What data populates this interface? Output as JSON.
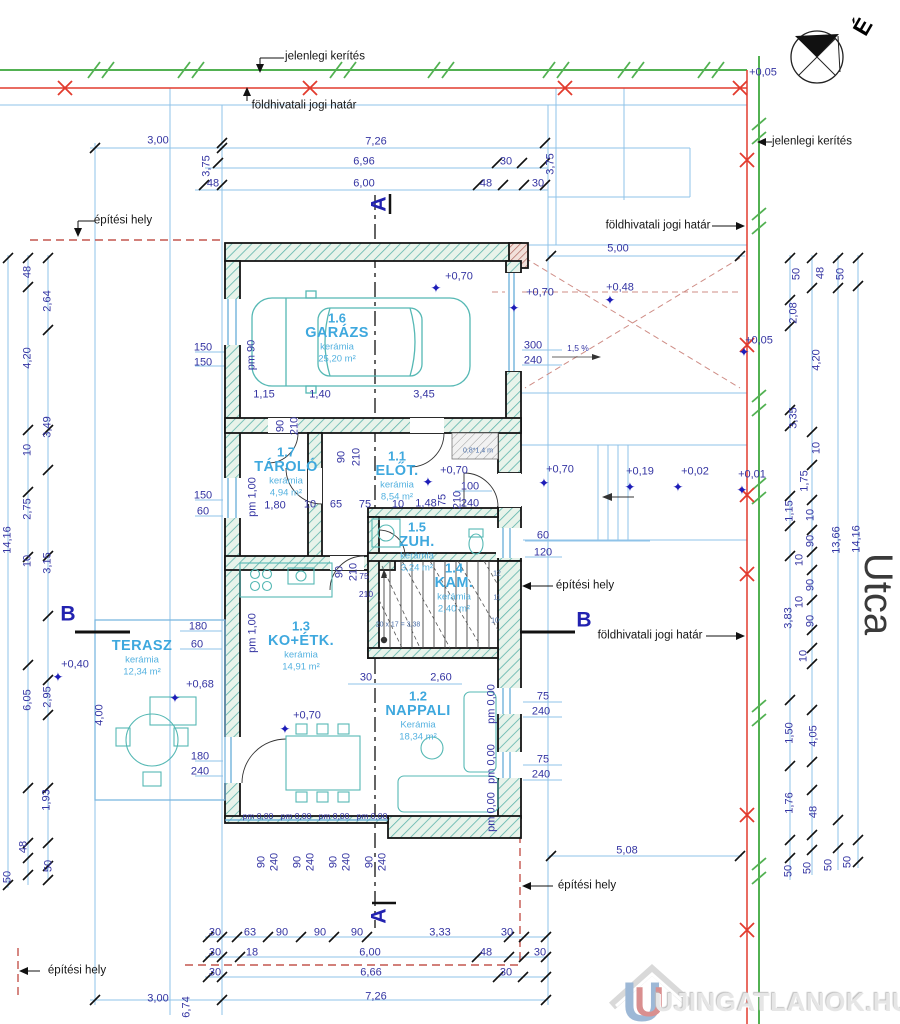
{
  "colors": {
    "dimension_blue": "#3434a2",
    "room_cyan": "#3ea8de",
    "furniture_teal": "#55b8b4",
    "boundary_red": "#e23b2e",
    "fence_green": "#52b152",
    "building_site_dashed": "#c4564e",
    "guide_blue": "#8fc3e8"
  },
  "compass": {
    "north_letter": "É"
  },
  "street": {
    "name": "Utca"
  },
  "watermark": {
    "text": "UJINGATLANOK.HU"
  },
  "rooms": [
    {
      "num": "1.6",
      "name": "GARÁZS",
      "material": "kerámia",
      "area": "25,20 m²",
      "x": 337,
      "y": 318
    },
    {
      "num": "1.7",
      "name": "TÁROLÓ",
      "material": "kerámia",
      "area": "4,94 m²",
      "x": 286,
      "y": 452
    },
    {
      "num": "1.1",
      "name": "ELŐT.",
      "material": "kerámia",
      "area": "8,54 m²",
      "x": 397,
      "y": 456
    },
    {
      "num": "1.5",
      "name": "ZUH.",
      "material": "kerámia",
      "area": "3,24 m²",
      "x": 417,
      "y": 527
    },
    {
      "num": "1.4",
      "name": "KAM.",
      "material": "kerámia",
      "area": "2,40 m²",
      "x": 454,
      "y": 568
    },
    {
      "num": "1.3",
      "name": "KO+ÉTK.",
      "material": "kerámia",
      "area": "14,91 m²",
      "x": 301,
      "y": 626
    },
    {
      "num": "1.2",
      "name": "NAPPALI",
      "material": "Kerámia",
      "area": "18,34 m²",
      "x": 418,
      "y": 696
    },
    {
      "num": "",
      "name": "TERASZ",
      "material": "kerámia",
      "area": "12,34 m²",
      "x": 142,
      "y": 631
    }
  ],
  "labels": [
    {
      "t": "jelenlegi kerítés",
      "x": 325,
      "y": 57,
      "c": "b",
      "n": "label-current-fence-top"
    },
    {
      "t": "földhivatali jogi határ",
      "x": 304,
      "y": 106,
      "c": "b",
      "n": "label-legal-boundary-top"
    },
    {
      "t": "jelenlegi kerítés",
      "x": 812,
      "y": 142,
      "c": "b",
      "n": "label-current-fence-right"
    },
    {
      "t": "földhivatali jogi határ",
      "x": 658,
      "y": 226,
      "c": "b",
      "n": "label-legal-boundary-right"
    },
    {
      "t": "építési hely",
      "x": 123,
      "y": 221,
      "c": "b",
      "n": "label-building-site-topleft"
    },
    {
      "t": "építési hely",
      "x": 585,
      "y": 586,
      "c": "b",
      "n": "label-building-site-right"
    },
    {
      "t": "földhivatali jogi határ",
      "x": 650,
      "y": 636,
      "c": "b",
      "n": "label-legal-boundary-mid"
    },
    {
      "t": "építési hely",
      "x": 587,
      "y": 886,
      "c": "b",
      "n": "label-building-site-bottomright"
    },
    {
      "t": "építési hely",
      "x": 77,
      "y": 971,
      "c": "b",
      "n": "label-building-site-bottomleft"
    },
    {
      "t": "A",
      "x": 379,
      "y": 204,
      "c": "sec",
      "r": -90,
      "n": "section-marker-a-top"
    },
    {
      "t": "A",
      "x": 379,
      "y": 916,
      "c": "sec",
      "r": -90,
      "n": "section-marker-a-bottom"
    },
    {
      "t": "B",
      "x": 68,
      "y": 614,
      "c": "sec",
      "n": "section-marker-b-left"
    },
    {
      "t": "B",
      "x": 584,
      "y": 620,
      "c": "sec",
      "n": "section-marker-b-right"
    },
    {
      "t": "Utca",
      "x": 878,
      "y": 594,
      "c": "u",
      "r": 90,
      "n": "street-name"
    },
    {
      "t": "É",
      "x": 863,
      "y": 27,
      "c": "comp",
      "r": -60,
      "n": "north-letter"
    },
    {
      "t": "UJINGATLANOK.HU",
      "x": 783,
      "y": 1002,
      "c": "wm",
      "n": "watermark-text"
    },
    {
      "t": "+0,05",
      "x": 763,
      "y": 73,
      "c": "d"
    },
    {
      "t": "3,00",
      "x": 158,
      "y": 141,
      "c": "d"
    },
    {
      "t": "7,26",
      "x": 376,
      "y": 142,
      "c": "d"
    },
    {
      "t": "6,96",
      "x": 364,
      "y": 162,
      "c": "d"
    },
    {
      "t": "30",
      "x": 506,
      "y": 162,
      "c": "d"
    },
    {
      "t": "3,75",
      "x": 207,
      "y": 166,
      "c": "d",
      "r": -90
    },
    {
      "t": "3,75",
      "x": 551,
      "y": 164,
      "c": "d",
      "r": -90
    },
    {
      "t": "48",
      "x": 213,
      "y": 184,
      "c": "d"
    },
    {
      "t": "6,00",
      "x": 364,
      "y": 184,
      "c": "d"
    },
    {
      "t": "48",
      "x": 486,
      "y": 184,
      "c": "d"
    },
    {
      "t": "30",
      "x": 538,
      "y": 184,
      "c": "d"
    },
    {
      "t": "5,00",
      "x": 618,
      "y": 249,
      "c": "d"
    },
    {
      "t": "+0,48",
      "x": 620,
      "y": 288,
      "c": "d"
    },
    {
      "t": "✦",
      "x": 610,
      "y": 300,
      "c": "s"
    },
    {
      "t": "+0,70",
      "x": 459,
      "y": 277,
      "c": "d"
    },
    {
      "t": "✦",
      "x": 436,
      "y": 288,
      "c": "s"
    },
    {
      "t": "+0,70",
      "x": 540,
      "y": 293,
      "c": "d"
    },
    {
      "t": "✦",
      "x": 514,
      "y": 308,
      "c": "s"
    },
    {
      "t": "+0,05",
      "x": 759,
      "y": 341,
      "c": "d"
    },
    {
      "t": "✦",
      "x": 744,
      "y": 352,
      "c": "s"
    },
    {
      "t": "150",
      "x": 203,
      "y": 348,
      "c": "d"
    },
    {
      "t": "150",
      "x": 203,
      "y": 363,
      "c": "d"
    },
    {
      "t": "pm 90",
      "x": 252,
      "y": 355,
      "c": "d",
      "r": -90
    },
    {
      "t": "300",
      "x": 533,
      "y": 346,
      "c": "d"
    },
    {
      "t": "240",
      "x": 533,
      "y": 361,
      "c": "d"
    },
    {
      "t": "1,5 %",
      "x": 578,
      "y": 348,
      "c": "d10"
    },
    {
      "t": "1,15",
      "x": 264,
      "y": 395,
      "c": "d"
    },
    {
      "t": "1,40",
      "x": 320,
      "y": 395,
      "c": "d"
    },
    {
      "t": "3,45",
      "x": 424,
      "y": 395,
      "c": "d"
    },
    {
      "t": "90",
      "x": 281,
      "y": 426,
      "c": "d",
      "r": -90
    },
    {
      "t": "210",
      "x": 295,
      "y": 426,
      "c": "d",
      "r": -90
    },
    {
      "t": "90",
      "x": 342,
      "y": 457,
      "c": "d",
      "r": -90
    },
    {
      "t": "210",
      "x": 357,
      "y": 457,
      "c": "d",
      "r": -90
    },
    {
      "t": "0,8*1,4 m",
      "x": 478,
      "y": 451,
      "c": "t"
    },
    {
      "t": "+0,70",
      "x": 454,
      "y": 471,
      "c": "d"
    },
    {
      "t": "✦",
      "x": 428,
      "y": 482,
      "c": "s"
    },
    {
      "t": "100",
      "x": 470,
      "y": 487,
      "c": "d"
    },
    {
      "t": "240",
      "x": 470,
      "y": 504,
      "c": "d"
    },
    {
      "t": "75",
      "x": 443,
      "y": 500,
      "c": "d",
      "r": -90
    },
    {
      "t": "210",
      "x": 458,
      "y": 500,
      "c": "d",
      "r": -90
    },
    {
      "t": "150",
      "x": 203,
      "y": 496,
      "c": "d"
    },
    {
      "t": "60",
      "x": 203,
      "y": 512,
      "c": "d"
    },
    {
      "t": "pm 1,00",
      "x": 253,
      "y": 497,
      "c": "d",
      "r": -90
    },
    {
      "t": "1,80",
      "x": 275,
      "y": 506,
      "c": "d"
    },
    {
      "t": "10",
      "x": 310,
      "y": 505,
      "c": "d"
    },
    {
      "t": "65",
      "x": 336,
      "y": 505,
      "c": "d"
    },
    {
      "t": "75",
      "x": 365,
      "y": 505,
      "c": "d"
    },
    {
      "t": "10",
      "x": 398,
      "y": 505,
      "c": "d"
    },
    {
      "t": "1,48",
      "x": 426,
      "y": 504,
      "c": "d"
    },
    {
      "t": "+0,70",
      "x": 560,
      "y": 470,
      "c": "d"
    },
    {
      "t": "✦",
      "x": 544,
      "y": 483,
      "c": "s"
    },
    {
      "t": "+0,19",
      "x": 640,
      "y": 472,
      "c": "d"
    },
    {
      "t": "✦",
      "x": 630,
      "y": 487,
      "c": "s"
    },
    {
      "t": "+0,02",
      "x": 695,
      "y": 472,
      "c": "d"
    },
    {
      "t": "✦",
      "x": 678,
      "y": 487,
      "c": "s"
    },
    {
      "t": "+0,01",
      "x": 752,
      "y": 475,
      "c": "d"
    },
    {
      "t": "✦",
      "x": 742,
      "y": 490,
      "c": "s"
    },
    {
      "t": "60",
      "x": 543,
      "y": 536,
      "c": "d"
    },
    {
      "t": "120",
      "x": 543,
      "y": 553,
      "c": "d"
    },
    {
      "t": "75",
      "x": 364,
      "y": 576,
      "c": "d10"
    },
    {
      "t": "210",
      "x": 366,
      "y": 594,
      "c": "d10"
    },
    {
      "t": "90",
      "x": 340,
      "y": 572,
      "c": "d",
      "r": -90
    },
    {
      "t": "210",
      "x": 354,
      "y": 572,
      "c": "d",
      "r": -90
    },
    {
      "t": "12",
      "x": 497,
      "y": 574,
      "c": "t"
    },
    {
      "t": "11",
      "x": 497,
      "y": 598,
      "c": "t"
    },
    {
      "t": "10",
      "x": 495,
      "y": 621,
      "c": "t"
    },
    {
      "t": "20 x 17 = 3,38",
      "x": 398,
      "y": 625,
      "c": "t"
    },
    {
      "t": "180",
      "x": 198,
      "y": 627,
      "c": "d"
    },
    {
      "t": "60",
      "x": 197,
      "y": 645,
      "c": "d"
    },
    {
      "t": "pm 1,00",
      "x": 253,
      "y": 633,
      "c": "d",
      "r": -90
    },
    {
      "t": "+0,70",
      "x": 307,
      "y": 716,
      "c": "d"
    },
    {
      "t": "✦",
      "x": 285,
      "y": 729,
      "c": "s"
    },
    {
      "t": "+0,68",
      "x": 200,
      "y": 685,
      "c": "d"
    },
    {
      "t": "✦",
      "x": 175,
      "y": 698,
      "c": "s"
    },
    {
      "t": "+0,40",
      "x": 75,
      "y": 665,
      "c": "d"
    },
    {
      "t": "✦",
      "x": 58,
      "y": 677,
      "c": "s"
    },
    {
      "t": "4,00",
      "x": 100,
      "y": 715,
      "c": "d",
      "r": -90
    },
    {
      "t": "30",
      "x": 366,
      "y": 678,
      "c": "d"
    },
    {
      "t": "2,60",
      "x": 441,
      "y": 678,
      "c": "d"
    },
    {
      "t": "pm 0,00",
      "x": 492,
      "y": 704,
      "c": "d",
      "r": -90
    },
    {
      "t": "pm 0,00",
      "x": 492,
      "y": 764,
      "c": "d",
      "r": -90
    },
    {
      "t": "pm 0,00",
      "x": 492,
      "y": 812,
      "c": "d",
      "r": -90
    },
    {
      "t": "75",
      "x": 543,
      "y": 697,
      "c": "d"
    },
    {
      "t": "240",
      "x": 541,
      "y": 712,
      "c": "d"
    },
    {
      "t": "75",
      "x": 543,
      "y": 760,
      "c": "d"
    },
    {
      "t": "240",
      "x": 541,
      "y": 775,
      "c": "d"
    },
    {
      "t": "180",
      "x": 200,
      "y": 757,
      "c": "d"
    },
    {
      "t": "240",
      "x": 200,
      "y": 772,
      "c": "d"
    },
    {
      "t": "pm 0,00",
      "x": 258,
      "y": 816,
      "c": "d10"
    },
    {
      "t": "pm 0,00",
      "x": 296,
      "y": 816,
      "c": "d10"
    },
    {
      "t": "pm 0,00",
      "x": 334,
      "y": 816,
      "c": "d10"
    },
    {
      "t": "pm 0,00",
      "x": 372,
      "y": 816,
      "c": "d10"
    },
    {
      "t": "90",
      "x": 262,
      "y": 862,
      "c": "d",
      "r": -90
    },
    {
      "t": "240",
      "x": 275,
      "y": 862,
      "c": "d",
      "r": -90
    },
    {
      "t": "90",
      "x": 298,
      "y": 862,
      "c": "d",
      "r": -90
    },
    {
      "t": "240",
      "x": 311,
      "y": 862,
      "c": "d",
      "r": -90
    },
    {
      "t": "90",
      "x": 334,
      "y": 862,
      "c": "d",
      "r": -90
    },
    {
      "t": "240",
      "x": 347,
      "y": 862,
      "c": "d",
      "r": -90
    },
    {
      "t": "90",
      "x": 370,
      "y": 862,
      "c": "d",
      "r": -90
    },
    {
      "t": "240",
      "x": 383,
      "y": 862,
      "c": "d",
      "r": -90
    },
    {
      "t": "5,08",
      "x": 627,
      "y": 851,
      "c": "d"
    },
    {
      "t": "48",
      "x": 28,
      "y": 272,
      "c": "d",
      "r": -90
    },
    {
      "t": "2,64",
      "x": 48,
      "y": 301,
      "c": "d",
      "r": -90
    },
    {
      "t": "4,20",
      "x": 28,
      "y": 358,
      "c": "d",
      "r": -90
    },
    {
      "t": "3,49",
      "x": 48,
      "y": 427,
      "c": "d",
      "r": -90
    },
    {
      "t": "10",
      "x": 28,
      "y": 450,
      "c": "d",
      "r": -90
    },
    {
      "t": "2,75",
      "x": 28,
      "y": 509,
      "c": "d",
      "r": -90
    },
    {
      "t": "14,16",
      "x": 8,
      "y": 540,
      "c": "d",
      "r": -90
    },
    {
      "t": "10",
      "x": 28,
      "y": 561,
      "c": "d",
      "r": -90
    },
    {
      "t": "3,15",
      "x": 48,
      "y": 563,
      "c": "d",
      "r": -90
    },
    {
      "t": "6,05",
      "x": 28,
      "y": 700,
      "c": "d",
      "r": -90
    },
    {
      "t": "2,95",
      "x": 48,
      "y": 697,
      "c": "d",
      "r": -90
    },
    {
      "t": "1,93",
      "x": 47,
      "y": 800,
      "c": "d",
      "r": -90
    },
    {
      "t": "48",
      "x": 24,
      "y": 847,
      "c": "d",
      "r": -90
    },
    {
      "t": "50",
      "x": 8,
      "y": 877,
      "c": "d",
      "r": -90
    },
    {
      "t": "50",
      "x": 49,
      "y": 866,
      "c": "d",
      "r": -90
    },
    {
      "t": "50",
      "x": 797,
      "y": 274,
      "c": "d",
      "r": -90
    },
    {
      "t": "48",
      "x": 821,
      "y": 273,
      "c": "d",
      "r": -90
    },
    {
      "t": "50",
      "x": 841,
      "y": 274,
      "c": "d",
      "r": -90
    },
    {
      "t": "2,08",
      "x": 794,
      "y": 313,
      "c": "d",
      "r": -90
    },
    {
      "t": "4,20",
      "x": 817,
      "y": 360,
      "c": "d",
      "r": -90
    },
    {
      "t": "3,35",
      "x": 794,
      "y": 418,
      "c": "d",
      "r": -90
    },
    {
      "t": "10",
      "x": 817,
      "y": 448,
      "c": "d",
      "r": -90
    },
    {
      "t": "1,75",
      "x": 805,
      "y": 481,
      "c": "d",
      "r": -90
    },
    {
      "t": "1,15",
      "x": 790,
      "y": 511,
      "c": "d",
      "r": -90
    },
    {
      "t": "10",
      "x": 811,
      "y": 515,
      "c": "d",
      "r": -90
    },
    {
      "t": "90",
      "x": 811,
      "y": 541,
      "c": "d",
      "r": -90
    },
    {
      "t": "10",
      "x": 800,
      "y": 560,
      "c": "d",
      "r": -90
    },
    {
      "t": "13,66",
      "x": 837,
      "y": 540,
      "c": "d",
      "r": -90
    },
    {
      "t": "14,16",
      "x": 857,
      "y": 539,
      "c": "d",
      "r": -90
    },
    {
      "t": "90",
      "x": 811,
      "y": 585,
      "c": "d",
      "r": -90
    },
    {
      "t": "10",
      "x": 800,
      "y": 602,
      "c": "d",
      "r": -90
    },
    {
      "t": "90",
      "x": 811,
      "y": 621,
      "c": "d",
      "r": -90
    },
    {
      "t": "3,83",
      "x": 789,
      "y": 618,
      "c": "d",
      "r": -90
    },
    {
      "t": "10",
      "x": 804,
      "y": 656,
      "c": "d",
      "r": -90
    },
    {
      "t": "1,50",
      "x": 790,
      "y": 733,
      "c": "d",
      "r": -90
    },
    {
      "t": "4,05",
      "x": 814,
      "y": 736,
      "c": "d",
      "r": -90
    },
    {
      "t": "1,76",
      "x": 790,
      "y": 803,
      "c": "d",
      "r": -90
    },
    {
      "t": "48",
      "x": 814,
      "y": 812,
      "c": "d",
      "r": -90
    },
    {
      "t": "50",
      "x": 789,
      "y": 871,
      "c": "d",
      "r": -90
    },
    {
      "t": "50",
      "x": 808,
      "y": 868,
      "c": "d",
      "r": -90
    },
    {
      "t": "50",
      "x": 829,
      "y": 865,
      "c": "d",
      "r": -90
    },
    {
      "t": "50",
      "x": 848,
      "y": 862,
      "c": "d",
      "r": -90
    },
    {
      "t": "30",
      "x": 215,
      "y": 933,
      "c": "d"
    },
    {
      "t": "63",
      "x": 250,
      "y": 933,
      "c": "d"
    },
    {
      "t": "90",
      "x": 282,
      "y": 933,
      "c": "d"
    },
    {
      "t": "90",
      "x": 320,
      "y": 933,
      "c": "d"
    },
    {
      "t": "90",
      "x": 357,
      "y": 933,
      "c": "d"
    },
    {
      "t": "3,33",
      "x": 440,
      "y": 933,
      "c": "d"
    },
    {
      "t": "30",
      "x": 507,
      "y": 933,
      "c": "d"
    },
    {
      "t": "30",
      "x": 215,
      "y": 953,
      "c": "d"
    },
    {
      "t": "18",
      "x": 252,
      "y": 953,
      "c": "d"
    },
    {
      "t": "6,00",
      "x": 370,
      "y": 953,
      "c": "d"
    },
    {
      "t": "48",
      "x": 486,
      "y": 953,
      "c": "d"
    },
    {
      "t": "30",
      "x": 540,
      "y": 953,
      "c": "d"
    },
    {
      "t": "30",
      "x": 215,
      "y": 973,
      "c": "d"
    },
    {
      "t": "6,66",
      "x": 371,
      "y": 973,
      "c": "d"
    },
    {
      "t": "30",
      "x": 506,
      "y": 973,
      "c": "d"
    },
    {
      "t": "7,26",
      "x": 376,
      "y": 997,
      "c": "d"
    },
    {
      "t": "3,00",
      "x": 158,
      "y": 999,
      "c": "d"
    },
    {
      "t": "6,74",
      "x": 187,
      "y": 1007,
      "c": "d",
      "r": -90
    }
  ]
}
